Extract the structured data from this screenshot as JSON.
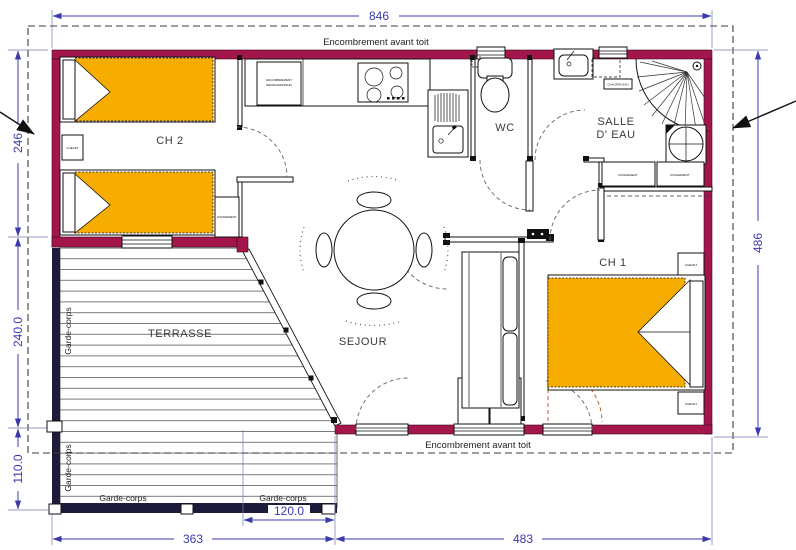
{
  "plan": {
    "dimensions": {
      "top_width": "846",
      "right_height": "486",
      "left_ch2_height": "246",
      "left_terrace_height": "240.0",
      "left_terrace_lower": "110.0",
      "terrace_width": "363",
      "terrace_inner_width": "120.0",
      "bottom_right_width": "483"
    },
    "labels": {
      "roof_overhang_top": "Encombrement avant toit",
      "roof_overhang_bottom": "Encombrement avant toit",
      "guardrail_left_upper": "Garde-corps",
      "guardrail_left_lower": "Garde-corps",
      "guardrail_bottom_left": "Garde-corps",
      "guardrail_bottom_right": "Garde-corps"
    },
    "rooms": {
      "ch2": "CH 2",
      "wc": "WC",
      "salle_eau_line1": "SALLE",
      "salle_eau_line2": "D' EAU",
      "ch1": "CH 1",
      "sejour": "SEJOUR",
      "terrasse": "TERRASSE"
    },
    "furniture": {
      "chevet_ch2": "CHEVET",
      "chevet_ch1_top": "CHEVET",
      "chevet_ch1_bottom": "CHEVET",
      "rangement_ch2": "RANGEMENT",
      "rangement_sde_left": "RANGEMENT",
      "rangement_sde_right": "RANGEMENT",
      "fridge_line1": "ENCOMBREMENT",
      "fridge_line2": "REFRIGERATEUR",
      "water_heater": "CHAUFFE-EAU"
    },
    "colors": {
      "wall": "#a3164b",
      "bed": "#f7ad00",
      "dim": "#3a3aad",
      "rail": "#1c1c3a",
      "alt_swing": "#c0522a"
    }
  }
}
